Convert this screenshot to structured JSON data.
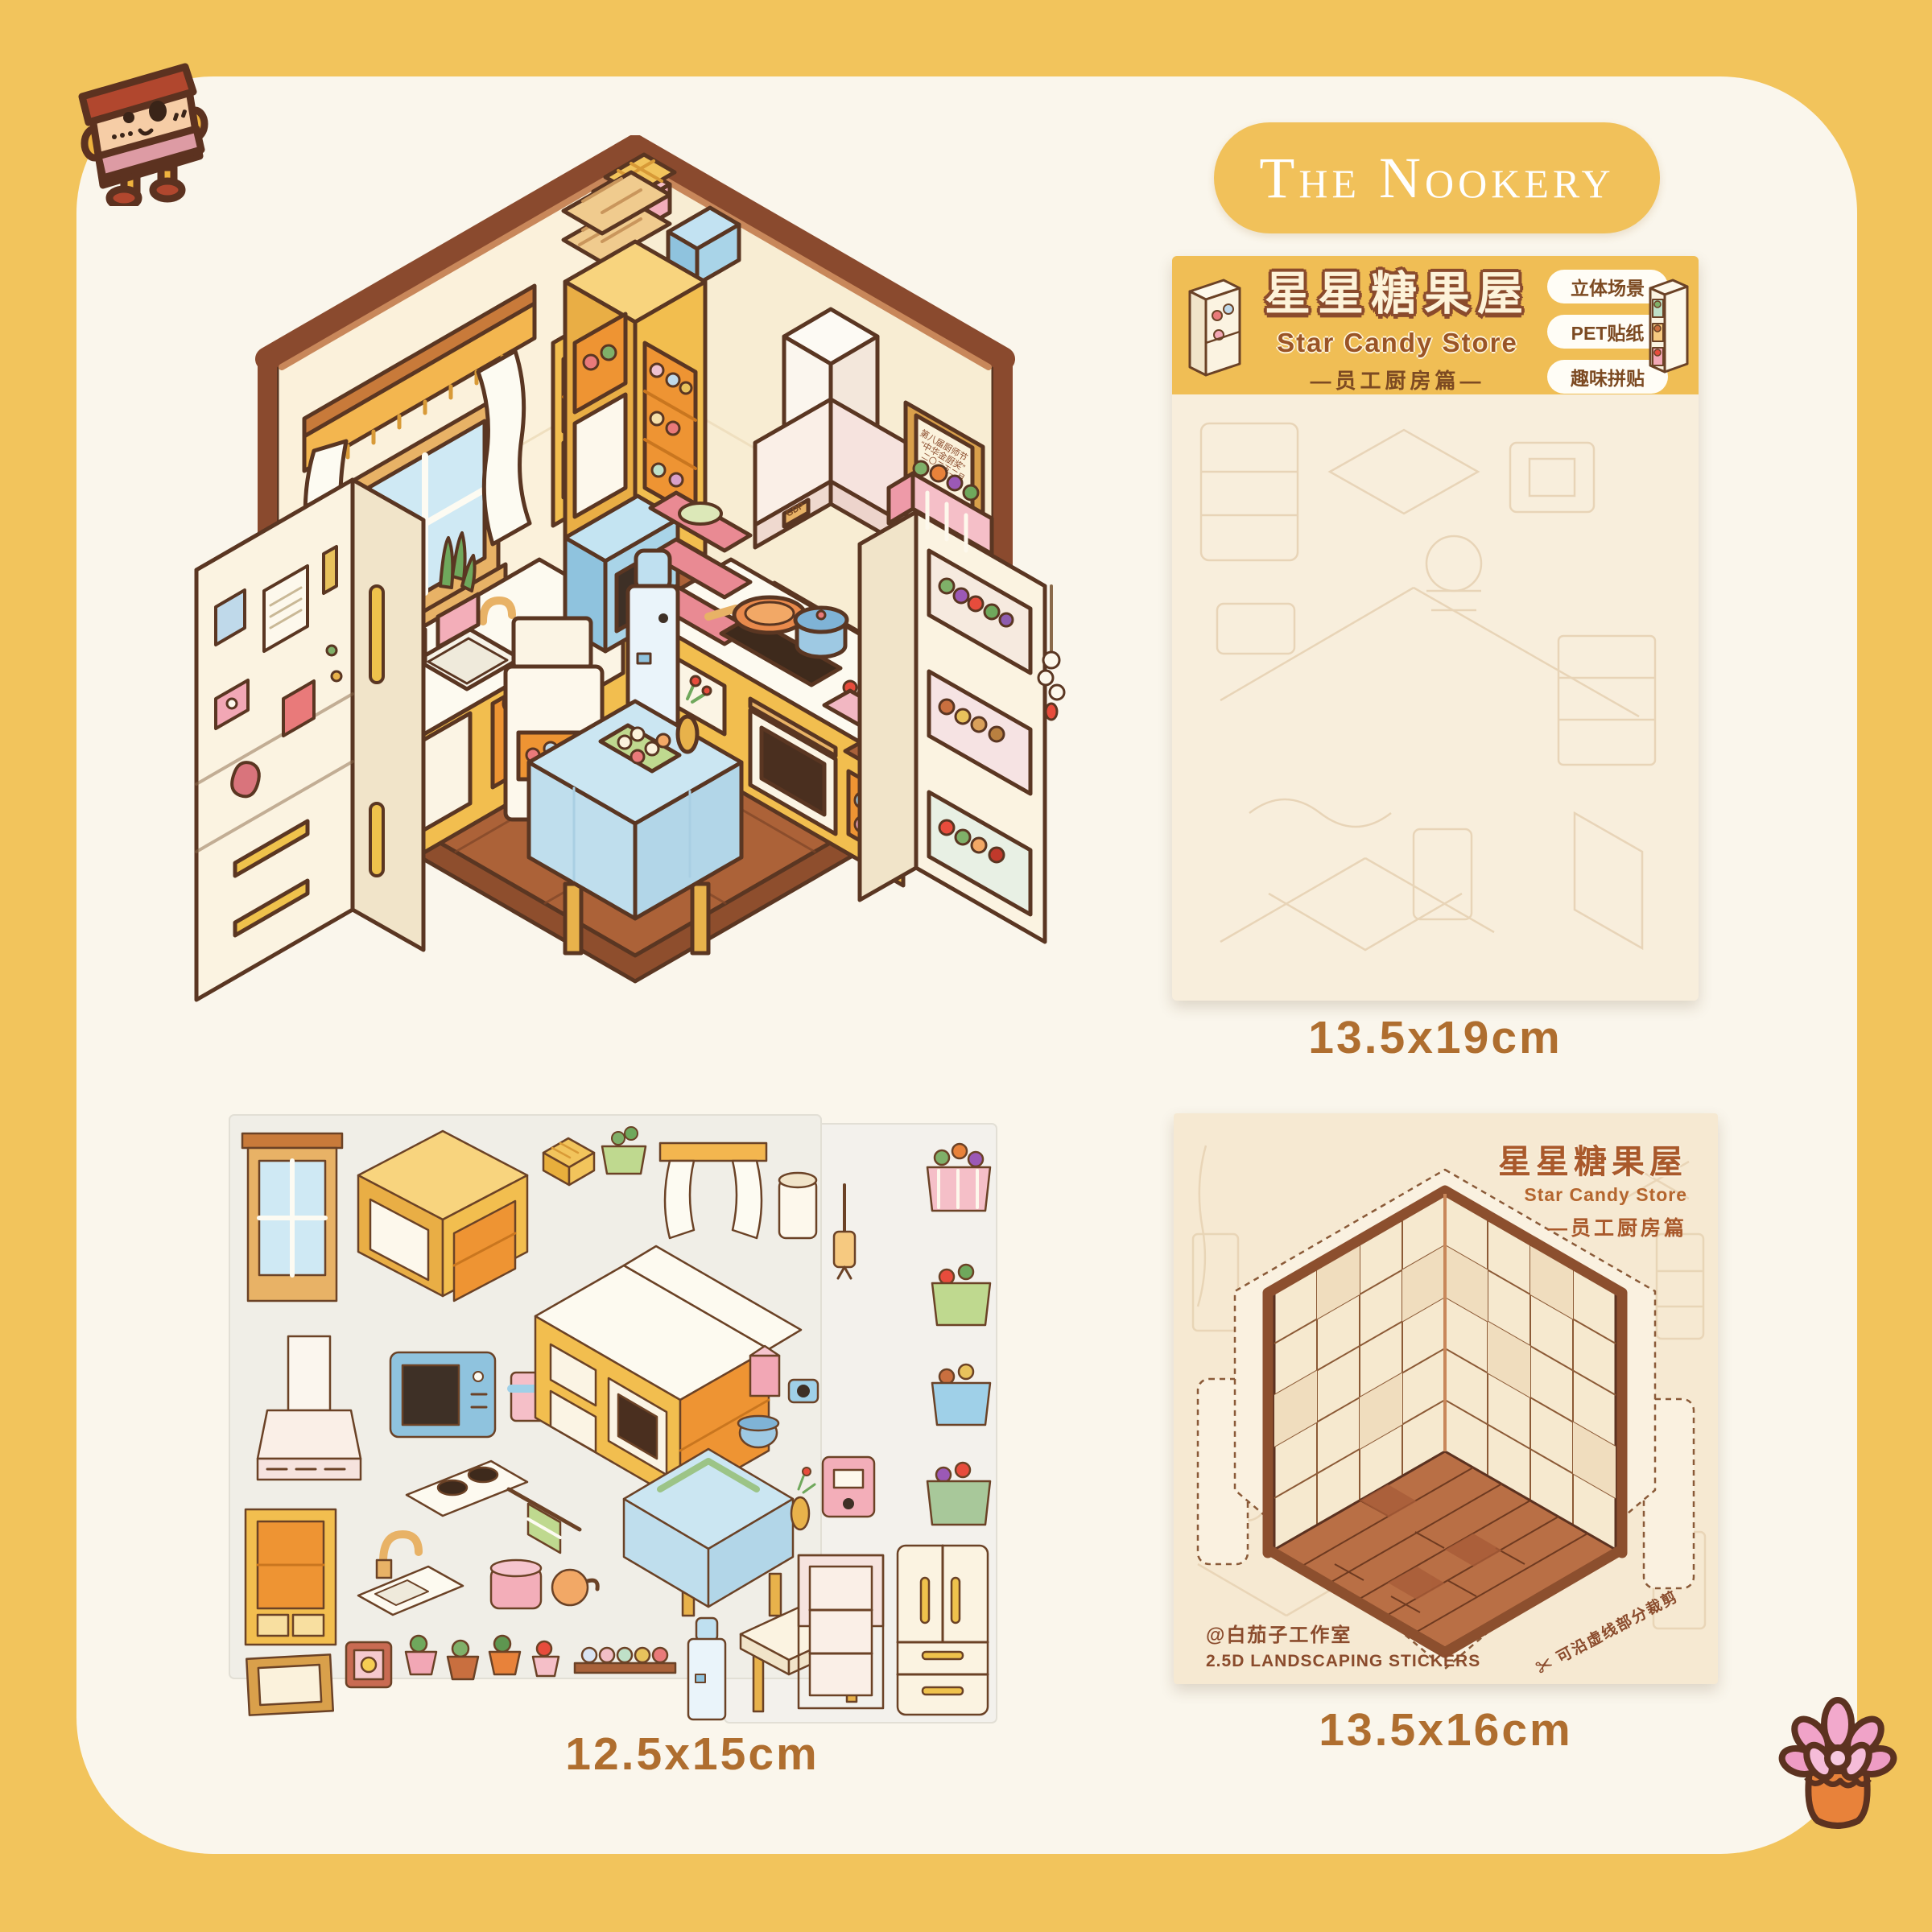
{
  "brand": {
    "logo_text": "The Nookery"
  },
  "package": {
    "title_cn": "星星糖果屋",
    "title_en": "Star Candy Store",
    "subtitle_cn": "—员工厨房篇—",
    "tags": [
      "立体场景",
      "PET贴纸",
      "趣味拼贴"
    ],
    "size": "13.5x19cm"
  },
  "sheets": {
    "size": "12.5x15cm"
  },
  "bg_card": {
    "title_cn": "星星糖果屋",
    "title_en": "Star Candy Store",
    "subtitle_cn": "—员工厨房篇",
    "studio": "@白茄子工作室",
    "type_line": "2.5D LANDSCAPING STICKERS",
    "cut_note": "可沿虚线部分裁剪",
    "size": "13.5x16cm"
  },
  "scene": {
    "plaque_line1": "第八届厨师节",
    "plaque_line2": "“中华金厨奖”",
    "plaque_line3": "二〇二五二月",
    "hood_badge": "GDP"
  },
  "icons": {
    "scissors": "✂"
  },
  "colors": {
    "border_yellow": "#F2C45C",
    "panel_cream": "#FAF6EC",
    "header_yellow": "#F0BE55",
    "text_brown": "#8A4B2C",
    "size_text_brown": "#AF6E2F",
    "package_cream": "#F8EEDC",
    "bg_card_cream": "#F6E9D2",
    "cabinet_yellow": "#F2BE4F",
    "floor_brown": "#AC6238"
  }
}
